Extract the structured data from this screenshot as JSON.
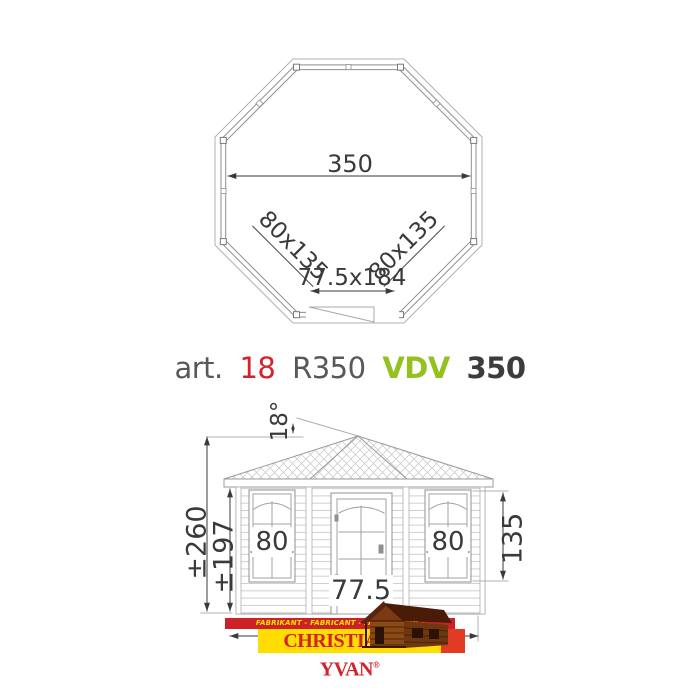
{
  "plan": {
    "diameter_label": "350",
    "window_left_label": "80x135",
    "window_right_label": "80x135",
    "door_label": "77.5x184"
  },
  "title": {
    "prefix": "art.",
    "article_number": "18",
    "model_code": "R350",
    "series_code": "VDV",
    "series_size": "350"
  },
  "elevation": {
    "roof_angle_label": "18°",
    "total_height_label": "±260",
    "wall_height_label": "±197",
    "window_width_left_label": "80",
    "window_width_right_label": "80",
    "window_height_label": "135",
    "door_width_label": "77.5"
  },
  "logo": {
    "tagline": "FABRIKANT - FABRICANT - FABRIKATION - MANUFACTURER",
    "brand_name": "CHRISTIAENS YVAN",
    "registered_mark": "®"
  },
  "colors": {
    "accent_red": "#d2232a",
    "accent_green": "#95c11f",
    "text_gray": "#58585b",
    "text_dark": "#3c3c3b",
    "banner_red": "#cc2127",
    "banner_yellow": "#ffdd00",
    "logo_square_red": "#e23b24",
    "line_gray": "#9a9a9a"
  }
}
